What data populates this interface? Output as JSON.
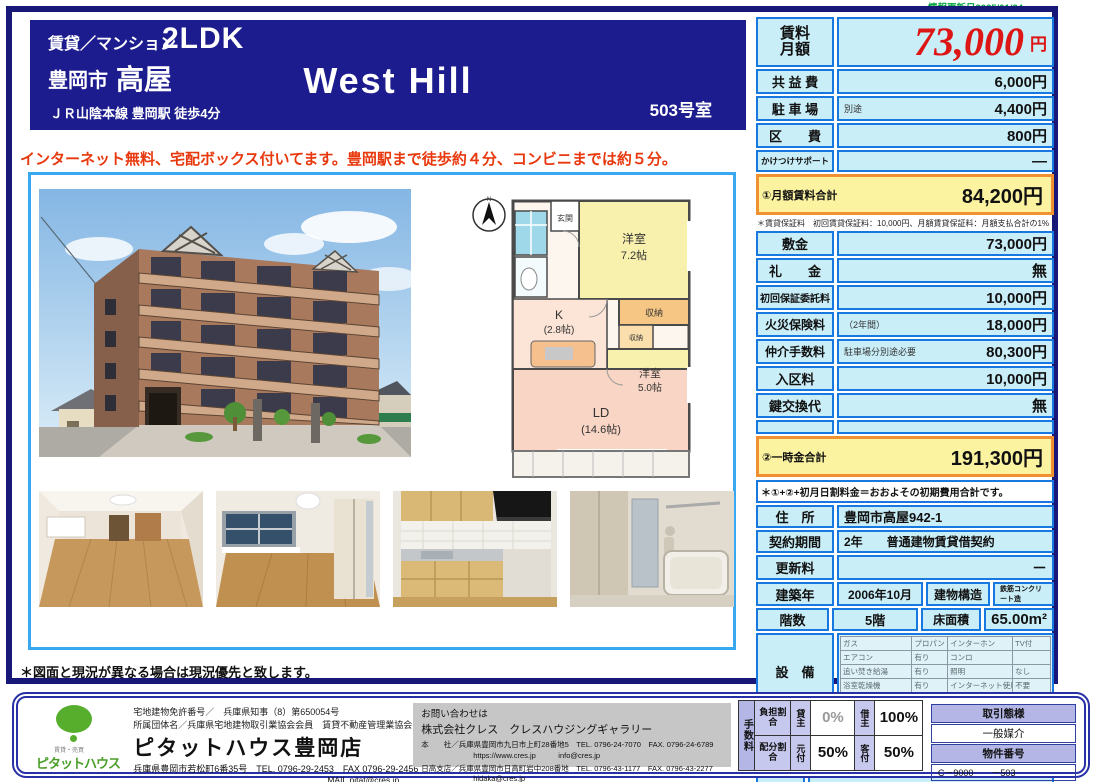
{
  "colors": {
    "navy": "#1c1c8e",
    "table_blue": "#1778e0",
    "cell_cyan": "#c9eef8",
    "highlight_yellow": "#fbf3a0",
    "highlight_orange": "#f09030",
    "price_red": "#dd1515",
    "catch_red": "#e8380d",
    "update_green": "#00a33c",
    "lavender": "#b4b6e6",
    "logo_green": "#56ae2c"
  },
  "meta": {
    "update_date": "情報更新日2025/01/24"
  },
  "header": {
    "category": "賃貸／マンション",
    "layout": "2LDK",
    "city": "豊岡市",
    "area": "高屋",
    "building_name": "West Hill",
    "room_no": "503号室",
    "access": "ＪＲ山陰本線 豊岡駅 徒歩4分"
  },
  "catch_copy": "インターネット無料、宅配ボックス付いてます。豊岡駅まで徒歩約４分、コンビニまでは約５分。",
  "monthly": {
    "rent_label_1": "賃料",
    "rent_label_2": "月額",
    "rent_value": "73,000",
    "rent_unit": "円",
    "rows": [
      {
        "label": "共 益 費",
        "note": "",
        "value": "6,000円"
      },
      {
        "label": "駐 車 場",
        "note": "別途",
        "value": "4,400円"
      },
      {
        "label": "区　　費",
        "note": "",
        "value": "800円"
      },
      {
        "label": "かけつけサポート",
        "note": "",
        "value": "—"
      }
    ],
    "total_label": "①月額賃料合計",
    "total_value": "84,200円",
    "note": "＊賃貸保証料　初回賃貸保証料：10,000円、月額賃貸保証料：月額支払合計の1%"
  },
  "initial": {
    "rows": [
      {
        "label": "敷金",
        "note": "",
        "value": "73,000円"
      },
      {
        "label": "礼　　金",
        "note": "",
        "value": "無"
      },
      {
        "label": "初回保証委託料",
        "note": "",
        "value": "10,000円"
      },
      {
        "label": "火災保険料",
        "note": "（2年間）",
        "value": "18,000円"
      },
      {
        "label": "仲介手数料",
        "note": "駐車場分別途必要",
        "value": "80,300円"
      },
      {
        "label": "入区料",
        "note": "",
        "value": "10,000円"
      },
      {
        "label": "鍵交換代",
        "note": "",
        "value": "無"
      }
    ],
    "total_label": "②一時金合計",
    "total_value": "191,300円",
    "note": "＊①+②+初月日割料金＝おおよその初期費用合計です。"
  },
  "property": {
    "address_label": "住　所",
    "address": "豊岡市高屋942-1",
    "contract_label": "契約期間",
    "contract": "2年　　普通建物賃貸借契約",
    "renewal_label": "更新料",
    "renewal": "－",
    "built_label": "建築年",
    "built": "2006年10月",
    "structure_label": "建物構造",
    "structure": "鉄筋コンクリート造",
    "floors_label": "階数",
    "floors": "5階",
    "floor_area_label": "床面積",
    "floor_area": "65.00m²"
  },
  "equipment": {
    "label": "設　備",
    "rows": [
      [
        "ガス",
        "プロパン",
        "インターホン",
        "TV付"
      ],
      [
        "エアコン",
        "有り",
        "コンロ",
        ""
      ],
      [
        "追い焚き給湯",
        "有り",
        "照明",
        "なし"
      ],
      [
        "浴室乾燥機",
        "有り",
        "インターネット使用料",
        "不要"
      ],
      [
        "温水洗浄便座",
        "有り",
        "オートロック",
        ""
      ]
    ]
  },
  "remarks": {
    "label": "備　考",
    "lines": [
      "●入区料・区費等は区の規約に従う。",
      "●退去時クリーニング代の目安：69,300円",
      "",
      "",
      "●仲介手数料・賃貸保証料は駐車場分が別途必要です。",
      "●月額賃料支払時の引落手数料・振込手数料は借主負担です。"
    ]
  },
  "availability": "入居可能時期：2025年10月下旬",
  "disclaimer": "＊図面と現況が異なる場合は現況優先と致します。",
  "floorplan": {
    "compass": "N",
    "entrance": "玄関",
    "room1_name": "洋室",
    "room1_size": "7.2帖",
    "closet1": "収納",
    "closet2": "収納",
    "kitchen": "K",
    "kitchen_size": "(2.8帖)",
    "room2_name": "洋室",
    "room2_size": "5.0帖",
    "ld": "LD",
    "ld_size": "(14.6帖)"
  },
  "footer": {
    "agency": {
      "license": "宅地建物免許番号／　兵庫県知事（8）第650054号",
      "association": "所属団体名／兵庫県宅地建物取引業協会会員　賃貸不動産管理業協会",
      "logo_small": "賃貸・売買",
      "logo_text": "ピタットハウス",
      "name": "ピタットハウス豊岡店",
      "address_tel": "兵庫県豊岡市若松町6番35号　TEL. 0796-29-2453　FAX 0796-29-2456",
      "mail": "MAIL.pitat@cres.jp"
    },
    "inquiry": {
      "title": "お問い合わせは",
      "company": "株式会社クレス　クレスハウジングギャラリー",
      "line1": "本　　社／兵庫県豊岡市九日市上町28番地5　TEL. 0796-24-7070　FAX. 0796-24-6789",
      "line2": "https://www.cres.jp　　　info@cres.jp",
      "line3": "日高支店／兵庫県豊岡市日高町岩中208番地　TEL. 0796-43-1177　FAX. 0796-43-2277",
      "line4": "hidaka@cres.jp"
    },
    "fee": {
      "vertical": "手数料",
      "burden_label": "負担割合",
      "lessor_label": "貸主",
      "lessor_value": "0%",
      "lessee_label": "借主",
      "lessee_value": "100%",
      "split_label": "配分割合",
      "motozuke_label": "元付",
      "motozuke_value": "50%",
      "kyakuzuke_label": "客付",
      "kyakuzuke_value": "50%"
    },
    "deal": {
      "type_label": "取引態様",
      "type_value": "一般媒介",
      "number_label": "物件番号",
      "number_value": "C－9000　　－503"
    }
  }
}
